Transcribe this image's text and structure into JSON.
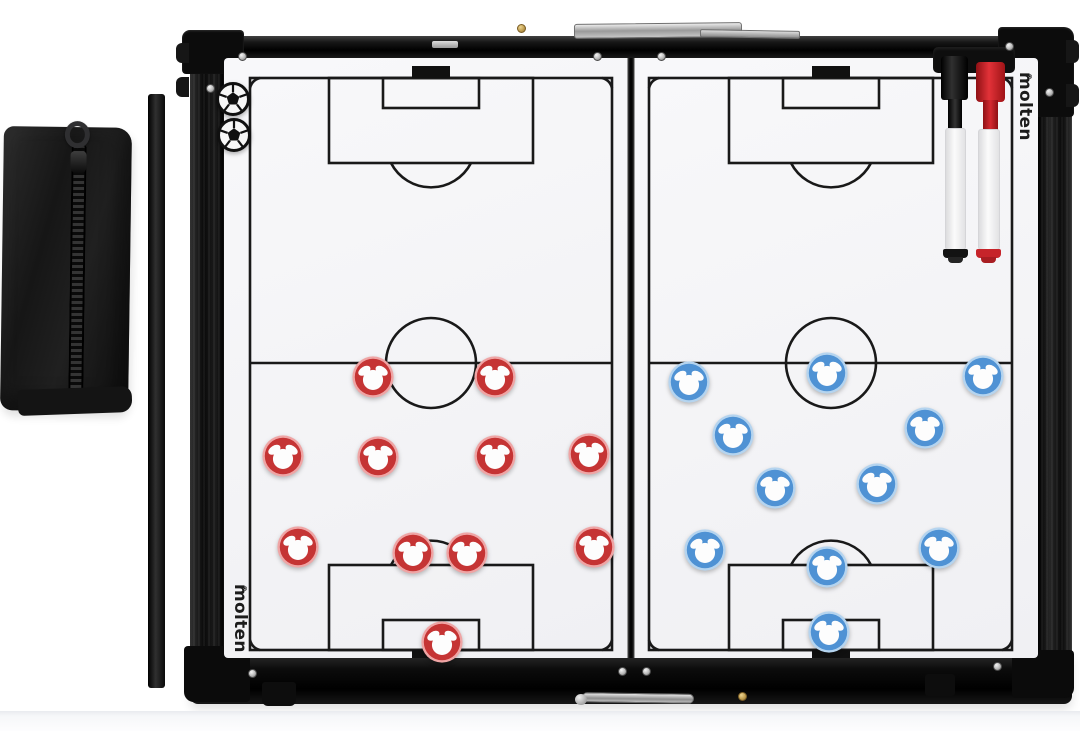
{
  "scene": {
    "type": "product-photo",
    "subject": "Folding magnetic soccer coaching tactics board with player magnets, markers and carry pouch",
    "background_color": "#ffffff"
  },
  "brand": {
    "name": "molten",
    "registered_mark": "®",
    "logo_color": "#1c1c1c"
  },
  "board": {
    "frame_color": "#131313",
    "panel_color": "#f5f5f6",
    "field_line_color": "#191919",
    "panel_count": 2
  },
  "teams": [
    {
      "id": "red",
      "magnet_color": "#c53434",
      "magnet_rim_color": "#efa5a5",
      "magnet_face_color": "#fdfdfd",
      "player_count": 11,
      "positions": [
        [
          373,
          377
        ],
        [
          495,
          377
        ],
        [
          283,
          456
        ],
        [
          378,
          457
        ],
        [
          495,
          456
        ],
        [
          589,
          454
        ],
        [
          298,
          547
        ],
        [
          413,
          553
        ],
        [
          467,
          553
        ],
        [
          594,
          547
        ],
        [
          442,
          642
        ]
      ]
    },
    {
      "id": "blue",
      "magnet_color": "#4f92d4",
      "magnet_rim_color": "#b5d4ef",
      "magnet_face_color": "#fdfdfd",
      "player_count": 11,
      "positions": [
        [
          689,
          382
        ],
        [
          827,
          373
        ],
        [
          983,
          376
        ],
        [
          733,
          435
        ],
        [
          925,
          428
        ],
        [
          775,
          488
        ],
        [
          877,
          484
        ],
        [
          705,
          550
        ],
        [
          827,
          567
        ],
        [
          939,
          548
        ],
        [
          829,
          632
        ]
      ]
    }
  ],
  "ball_magnets": {
    "count": 2,
    "positions": [
      [
        233,
        99
      ],
      [
        234,
        135
      ]
    ]
  },
  "markers": [
    {
      "id": "black-marker",
      "cap_color": "#141414",
      "barrel_color": "#f4f4f4",
      "tip_color": "#1a1a1a"
    },
    {
      "id": "red-marker",
      "cap_color": "#d2262c",
      "barrel_color": "#f4f4f4",
      "tip_color": "#c6242a"
    }
  ],
  "accessories": {
    "pouch_color": "#1c1c1e",
    "support_bar_color": "#0e0e0e"
  },
  "hardware": {
    "screw_color": "#c9c9c9",
    "gold_screw_color": "#b3924a",
    "screws": [
      [
        242,
        56
      ],
      [
        210,
        88
      ],
      [
        597,
        56
      ],
      [
        661,
        56
      ],
      [
        1009,
        46
      ],
      [
        1049,
        92
      ],
      [
        252,
        673
      ],
      [
        622,
        671
      ],
      [
        646,
        671
      ],
      [
        997,
        666
      ]
    ],
    "gold_screws": [
      [
        521,
        28
      ],
      [
        742,
        696
      ]
    ]
  }
}
